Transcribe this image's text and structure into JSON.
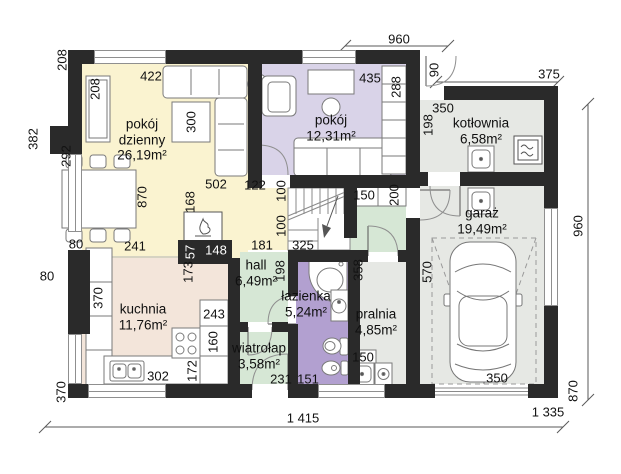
{
  "rooms": {
    "living": {
      "name": "pokój dzienny",
      "area": "26,19m²"
    },
    "bedroom": {
      "name": "pokój",
      "area": "12,31m²"
    },
    "boiler": {
      "name": "kotłownia",
      "area": "6,58m²"
    },
    "garage": {
      "name": "garaż",
      "area": "19,49m²"
    },
    "kitchen": {
      "name": "kuchnia",
      "area": "11,76m²"
    },
    "hall": {
      "name": "hall",
      "area": "6,49m²"
    },
    "bath": {
      "name": "łazienka",
      "area": "5,24m²"
    },
    "vestibule": {
      "name": "wiatrołap",
      "area": "3,58m²"
    },
    "laundry": {
      "name": "pralnia",
      "area": "4,85m²"
    }
  },
  "dims": {
    "top_960": "960",
    "door_90": "90",
    "kotl_375": "375",
    "right_960": "960",
    "right_870": "870",
    "bottom_1415": "1 415",
    "bottom_1335": "1 335",
    "out_208": "208",
    "out_382": "382",
    "out_80": "80",
    "out_370": "370",
    "living_208": "208",
    "living_292": "292",
    "living_422": "422",
    "living_300": "300",
    "living_870": "870",
    "living_502": "502",
    "living_122": "122",
    "living_100a": "100",
    "living_100b": "100",
    "living_168": "168",
    "living_241": "241",
    "living_80": "80",
    "wall_57": "57",
    "wall_148": "148",
    "opening_181": "181",
    "opening_325": "325",
    "kitchen_173": "173",
    "hall_198": "198",
    "cab_150": "150",
    "cab_200": "200",
    "kotl_350": "350",
    "kotl_198": "198",
    "bedroom_435": "435",
    "bedroom_288": "288",
    "garage_570": "570",
    "laundry_358": "358",
    "garage_350": "350",
    "kitchen_370": "370",
    "kitchen_243": "243",
    "kitchen_160": "160",
    "kitchen_172": "172",
    "kitchen_302": "302",
    "laundry_150": "150",
    "vest_231": "231",
    "bath_151": "151"
  },
  "colors": {
    "wall": "#2a2a2a",
    "floor-living": "#faf3d0",
    "floor-bedroom": "#d9d3e8",
    "floor-hall": "#d6e7d5",
    "floor-bath": "#b2a0d0",
    "floor-kitchen": "#f3e5da",
    "floor-utility": "#e6e8e4"
  }
}
